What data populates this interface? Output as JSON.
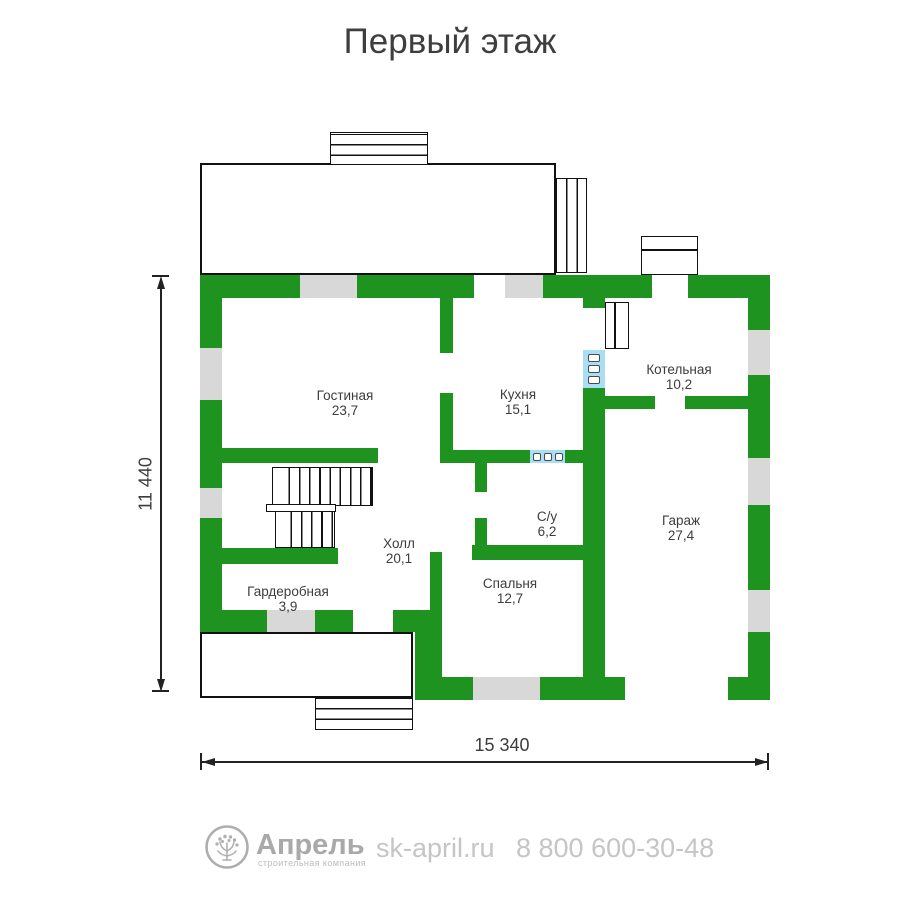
{
  "title": "Первый этаж",
  "plan": {
    "rooms": [
      {
        "id": "living",
        "name": "Гостиная",
        "area": "23,7"
      },
      {
        "id": "kitchen",
        "name": "Кухня",
        "area": "15,1"
      },
      {
        "id": "boiler",
        "name": "Котельная",
        "area": "10,2"
      },
      {
        "id": "garage",
        "name": "Гараж",
        "area": "27,4"
      },
      {
        "id": "hall",
        "name": "Холл",
        "area": "20,1"
      },
      {
        "id": "bathroom",
        "name": "С/у",
        "area": "6,2"
      },
      {
        "id": "bedroom",
        "name": "Спальня",
        "area": "12,7"
      },
      {
        "id": "wardrobe",
        "name": "Гардеробная",
        "area": "3,9"
      }
    ],
    "dimensions": {
      "height_label": "11 440",
      "width_label": "15 340"
    },
    "colors": {
      "wall": "#1e9320",
      "window": "#d8d8d8",
      "glass": "#aadef5",
      "label": "#3d3d3d"
    }
  },
  "footer": {
    "brand": "Апрель",
    "brand_subtitle": "строительная компания",
    "website": "sk-april.ru",
    "phone": "8 800 600-30-48"
  }
}
